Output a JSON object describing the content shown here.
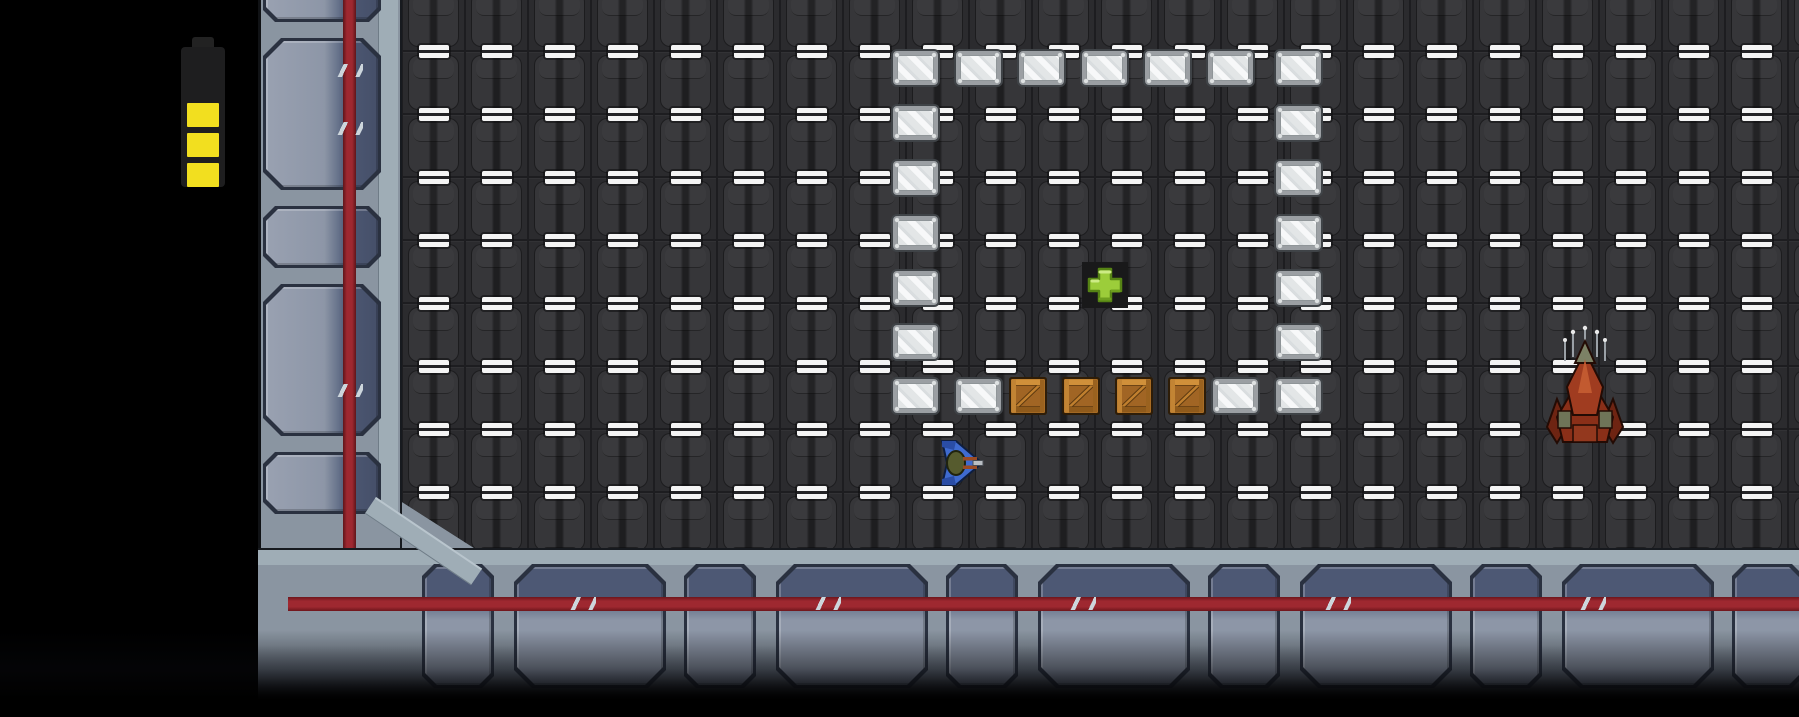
{
  "scene": {
    "type": "top-down space station game viewport",
    "viewport": {
      "width": 1799,
      "height": 717
    }
  },
  "hud": {
    "battery": {
      "bars_filled": 3,
      "bars_total": 3,
      "bar_color": "#f2df1f",
      "body_color": "#1e1e1f"
    }
  },
  "palette": {
    "background": "#000000",
    "floor_tile": "#2b2b2e",
    "floor_mark": "#f4f4f4",
    "wall_base": "#8a95a1",
    "wall_coping": "#9fadb6",
    "wall_panel_light": "#8d96a7",
    "wall_panel_dark": "#4d5874",
    "wall_stripe_red": "#9e2830",
    "glass_frame": "#9b9fa3",
    "glass_pane": "#e8eaeb",
    "crate_orange": "#b5772b",
    "medkit_green": "#9ccd3a",
    "player_blue": "#3f6bd0",
    "enemy_red": "#8a2f18"
  },
  "map": {
    "tile_size": 63,
    "floor": {
      "x": 402,
      "y": 0,
      "width": 1397,
      "height": 548
    },
    "glass_blocks": [
      [
        891,
        49
      ],
      [
        954,
        49
      ],
      [
        1017,
        49
      ],
      [
        1080,
        49
      ],
      [
        1143,
        49
      ],
      [
        1206,
        49
      ],
      [
        1274,
        49
      ],
      [
        891,
        104
      ],
      [
        891,
        159
      ],
      [
        891,
        214
      ],
      [
        891,
        269
      ],
      [
        891,
        323
      ],
      [
        891,
        377
      ],
      [
        1274,
        104
      ],
      [
        1274,
        159
      ],
      [
        1274,
        214
      ],
      [
        1274,
        269
      ],
      [
        1274,
        323
      ],
      [
        1274,
        377
      ],
      [
        954,
        377
      ],
      [
        1211,
        377
      ]
    ],
    "crates": [
      [
        1009,
        377
      ],
      [
        1062,
        377
      ],
      [
        1115,
        377
      ],
      [
        1168,
        377
      ]
    ],
    "medkit": {
      "x": 1082,
      "y": 262,
      "size": 46
    },
    "player_ship": {
      "x": 938,
      "y": 437,
      "width": 46,
      "height": 52,
      "facing": "right"
    },
    "enemy_ship": {
      "x": 1545,
      "y": 325,
      "width": 80,
      "height": 122,
      "facing": "up"
    },
    "battery_indicator": {
      "x": 181,
      "y": 37
    }
  }
}
